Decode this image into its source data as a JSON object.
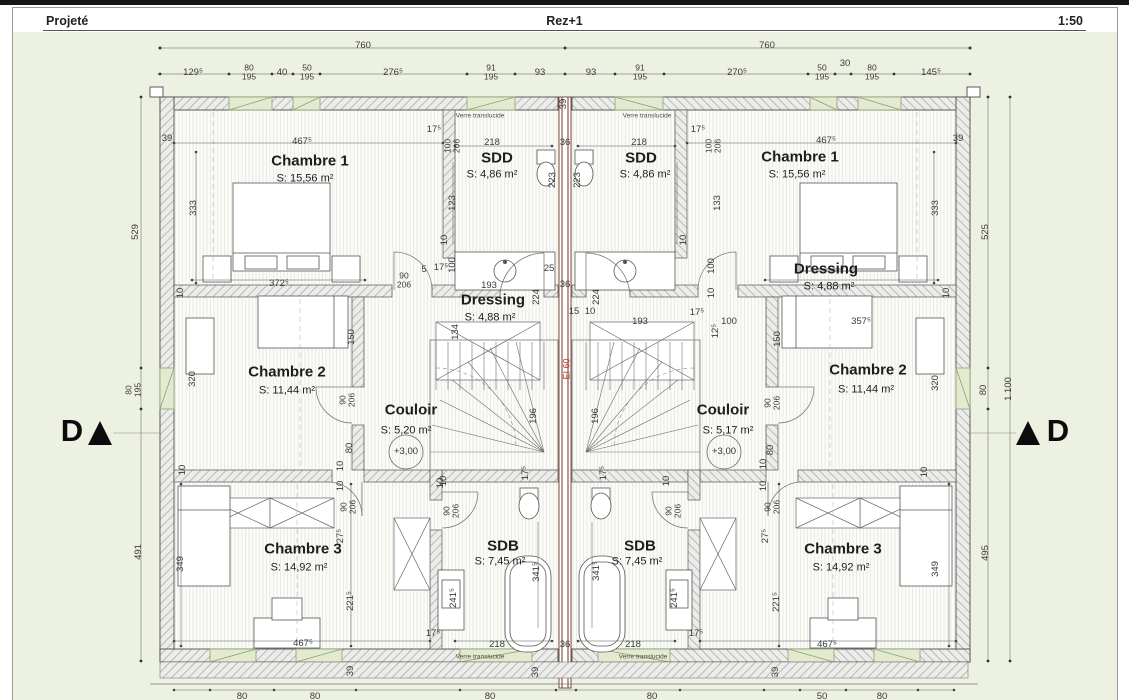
{
  "header": {
    "project_state": "Projeté",
    "level": "Rez+1",
    "scale": "1:50"
  },
  "plan": {
    "fire_rating": {
      "t": "EI 60",
      "x": 567,
      "y": 369
    },
    "markers": {
      "left": "D",
      "right": "D"
    },
    "levels": [
      {
        "t": "+3,00",
        "x": 406,
        "y": 452
      },
      {
        "t": "+3,00",
        "x": 724,
        "y": 452
      }
    ],
    "glass_notes": [
      {
        "t": "Verre translucide",
        "x": 480,
        "y": 117
      },
      {
        "t": "Verre translucide",
        "x": 647,
        "y": 117
      },
      {
        "t": "Verre translucide",
        "x": 480,
        "y": 658
      },
      {
        "t": "Verre translucide",
        "x": 643,
        "y": 658
      }
    ],
    "rooms": [
      {
        "name": "Chambre 1",
        "area": "S: 15,56 m²",
        "nx": 310,
        "ny": 161,
        "ax": 305,
        "ay": 179
      },
      {
        "name": "SDD",
        "area": "S: 4,86 m²",
        "nx": 497,
        "ny": 158,
        "ax": 492,
        "ay": 175
      },
      {
        "name": "Dressing",
        "area": "S: 4,88 m²",
        "nx": 493,
        "ny": 300,
        "ax": 490,
        "ay": 318
      },
      {
        "name": "Chambre 2",
        "area": "S: 11,44 m²",
        "nx": 287,
        "ny": 372,
        "ax": 287,
        "ay": 391
      },
      {
        "name": "Couloir",
        "area": "S: 5,20 m²",
        "nx": 411,
        "ny": 410,
        "ax": 406,
        "ay": 431
      },
      {
        "name": "Chambre 3",
        "area": "S: 14,92 m²",
        "nx": 303,
        "ny": 549,
        "ax": 299,
        "ay": 568
      },
      {
        "name": "SDB",
        "area": "S: 7,45 m²",
        "nx": 503,
        "ny": 546,
        "ax": 500,
        "ay": 562
      },
      {
        "name": "SDD",
        "area": "S: 4,86 m²",
        "nx": 641,
        "ny": 158,
        "ax": 645,
        "ay": 175
      },
      {
        "name": "Chambre 1",
        "area": "S: 15,56 m²",
        "nx": 800,
        "ny": 157,
        "ax": 797,
        "ay": 175
      },
      {
        "name": "Dressing",
        "area": "S: 4,88 m²",
        "nx": 826,
        "ny": 269,
        "ax": 829,
        "ay": 287
      },
      {
        "name": "Chambre 2",
        "area": "S: 11,44 m²",
        "nx": 868,
        "ny": 370,
        "ax": 866,
        "ay": 390
      },
      {
        "name": "Couloir",
        "area": "S: 5,17 m²",
        "nx": 723,
        "ny": 410,
        "ax": 728,
        "ay": 431
      },
      {
        "name": "SDB",
        "area": "S: 7,45 m²",
        "nx": 640,
        "ny": 546,
        "ax": 637,
        "ay": 562
      },
      {
        "name": "Chambre 3",
        "area": "S: 14,92 m²",
        "nx": 843,
        "ny": 549,
        "ax": 841,
        "ay": 568
      }
    ],
    "dims": [
      {
        "t": "760",
        "x": 363,
        "y": 46
      },
      {
        "t": "760",
        "x": 767,
        "y": 46
      },
      {
        "t": "129⁵",
        "x": 193,
        "y": 73
      },
      {
        "t": "80\n195",
        "x": 249,
        "y": 72,
        "s": 1
      },
      {
        "t": "40",
        "x": 282,
        "y": 73
      },
      {
        "t": "50\n195",
        "x": 307,
        "y": 72,
        "s": 1
      },
      {
        "t": "276⁵",
        "x": 393,
        "y": 73
      },
      {
        "t": "91\n195",
        "x": 491,
        "y": 72,
        "s": 1
      },
      {
        "t": "93",
        "x": 540,
        "y": 73
      },
      {
        "t": "93",
        "x": 591,
        "y": 73
      },
      {
        "t": "91\n195",
        "x": 640,
        "y": 72,
        "s": 1
      },
      {
        "t": "270⁵",
        "x": 737,
        "y": 73
      },
      {
        "t": "50\n195",
        "x": 822,
        "y": 72,
        "s": 1
      },
      {
        "t": "30",
        "x": 845,
        "y": 64
      },
      {
        "t": "80\n195",
        "x": 872,
        "y": 72,
        "s": 1
      },
      {
        "t": "145⁵",
        "x": 931,
        "y": 73
      },
      {
        "t": "529",
        "x": 136,
        "y": 232,
        "r": 1
      },
      {
        "t": "80\n195",
        "x": 133,
        "y": 390,
        "r": 1,
        "s": 1
      },
      {
        "t": "491",
        "x": 139,
        "y": 552,
        "r": 1
      },
      {
        "t": "525",
        "x": 986,
        "y": 232,
        "r": 1
      },
      {
        "t": "80",
        "x": 984,
        "y": 390,
        "r": 1
      },
      {
        "t": "495",
        "x": 986,
        "y": 553,
        "r": 1
      },
      {
        "t": "1.100",
        "x": 1009,
        "y": 389,
        "r": 1
      },
      {
        "t": "39",
        "x": 167,
        "y": 139
      },
      {
        "t": "467⁵",
        "x": 302,
        "y": 142
      },
      {
        "t": "17⁵",
        "x": 434,
        "y": 130
      },
      {
        "t": "100\n206",
        "x": 452,
        "y": 146,
        "r": 1,
        "s": 1
      },
      {
        "t": "218",
        "x": 492,
        "y": 143
      },
      {
        "t": "223",
        "x": 553,
        "y": 180,
        "r": 1
      },
      {
        "t": "36",
        "x": 565,
        "y": 143
      },
      {
        "t": "39",
        "x": 564,
        "y": 104,
        "r": 1
      },
      {
        "t": "223",
        "x": 578,
        "y": 180,
        "r": 1
      },
      {
        "t": "218",
        "x": 639,
        "y": 143
      },
      {
        "t": "100\n206",
        "x": 713,
        "y": 146,
        "r": 1,
        "s": 1
      },
      {
        "t": "17⁵",
        "x": 698,
        "y": 130
      },
      {
        "t": "467⁵",
        "x": 826,
        "y": 141
      },
      {
        "t": "39",
        "x": 958,
        "y": 139
      },
      {
        "t": "333",
        "x": 194,
        "y": 208,
        "r": 1
      },
      {
        "t": "123",
        "x": 453,
        "y": 203,
        "r": 1
      },
      {
        "t": "133",
        "x": 718,
        "y": 203,
        "r": 1
      },
      {
        "t": "333",
        "x": 936,
        "y": 208,
        "r": 1
      },
      {
        "t": "10",
        "x": 445,
        "y": 240,
        "r": 1
      },
      {
        "t": "10",
        "x": 684,
        "y": 240,
        "r": 1
      },
      {
        "t": "100",
        "x": 453,
        "y": 265,
        "r": 1
      },
      {
        "t": "100",
        "x": 712,
        "y": 266,
        "r": 1
      },
      {
        "t": "10",
        "x": 181,
        "y": 293,
        "r": 1
      },
      {
        "t": "10",
        "x": 947,
        "y": 293,
        "r": 1
      },
      {
        "t": "372⁵",
        "x": 279,
        "y": 284
      },
      {
        "t": "357⁵",
        "x": 861,
        "y": 322
      },
      {
        "t": "90\n206",
        "x": 404,
        "y": 280,
        "s": 1
      },
      {
        "t": "5",
        "x": 424,
        "y": 270
      },
      {
        "t": "17⁵",
        "x": 441,
        "y": 268
      },
      {
        "t": "25",
        "x": 549,
        "y": 269
      },
      {
        "t": "36",
        "x": 565,
        "y": 285
      },
      {
        "t": "193",
        "x": 489,
        "y": 286
      },
      {
        "t": "15",
        "x": 574,
        "y": 312
      },
      {
        "t": "10",
        "x": 590,
        "y": 312
      },
      {
        "t": "224",
        "x": 537,
        "y": 297,
        "r": 1
      },
      {
        "t": "224",
        "x": 597,
        "y": 297,
        "r": 1
      },
      {
        "t": "134",
        "x": 456,
        "y": 332,
        "r": 1
      },
      {
        "t": "193",
        "x": 640,
        "y": 322
      },
      {
        "t": "17⁵",
        "x": 697,
        "y": 313
      },
      {
        "t": "100",
        "x": 729,
        "y": 322
      },
      {
        "t": "12⁵",
        "x": 716,
        "y": 331,
        "r": 1
      },
      {
        "t": "10",
        "x": 712,
        "y": 293,
        "r": 1
      },
      {
        "t": "320",
        "x": 193,
        "y": 379,
        "r": 1
      },
      {
        "t": "150",
        "x": 352,
        "y": 337,
        "r": 1
      },
      {
        "t": "90\n206",
        "x": 347,
        "y": 400,
        "r": 1,
        "s": 1
      },
      {
        "t": "80",
        "x": 350,
        "y": 448,
        "r": 1
      },
      {
        "t": "10",
        "x": 341,
        "y": 466,
        "r": 1
      },
      {
        "t": "10",
        "x": 183,
        "y": 470,
        "r": 1
      },
      {
        "t": "150",
        "x": 778,
        "y": 339,
        "r": 1
      },
      {
        "t": "320",
        "x": 936,
        "y": 383,
        "r": 1
      },
      {
        "t": "90\n206",
        "x": 772,
        "y": 403,
        "r": 1,
        "s": 1
      },
      {
        "t": "80",
        "x": 771,
        "y": 450,
        "r": 1
      },
      {
        "t": "10",
        "x": 764,
        "y": 464,
        "r": 1
      },
      {
        "t": "10",
        "x": 925,
        "y": 472,
        "r": 1
      },
      {
        "t": "196",
        "x": 534,
        "y": 416,
        "r": 1
      },
      {
        "t": "196",
        "x": 596,
        "y": 416,
        "r": 1
      },
      {
        "t": "17⁵",
        "x": 526,
        "y": 473,
        "r": 1
      },
      {
        "t": "17⁵",
        "x": 604,
        "y": 473,
        "r": 1
      },
      {
        "t": "10",
        "x": 444,
        "y": 481,
        "r": 1
      },
      {
        "t": "10",
        "x": 667,
        "y": 481,
        "r": 1
      },
      {
        "t": "90\n206",
        "x": 348,
        "y": 507,
        "r": 1,
        "s": 1
      },
      {
        "t": "10",
        "x": 341,
        "y": 486,
        "r": 1
      },
      {
        "t": "90\n206",
        "x": 451,
        "y": 511,
        "r": 1,
        "s": 1
      },
      {
        "t": "10",
        "x": 441,
        "y": 483,
        "r": 1
      },
      {
        "t": "90\n206",
        "x": 673,
        "y": 511,
        "r": 1,
        "s": 1
      },
      {
        "t": "90\n206",
        "x": 772,
        "y": 507,
        "r": 1,
        "s": 1
      },
      {
        "t": "10",
        "x": 764,
        "y": 486,
        "r": 1
      },
      {
        "t": "349",
        "x": 181,
        "y": 564,
        "r": 1
      },
      {
        "t": "27⁵",
        "x": 341,
        "y": 536,
        "r": 1
      },
      {
        "t": "221⁵",
        "x": 351,
        "y": 601,
        "r": 1
      },
      {
        "t": "467⁵",
        "x": 303,
        "y": 644
      },
      {
        "t": "39",
        "x": 351,
        "y": 671,
        "r": 1
      },
      {
        "t": "341⁵",
        "x": 537,
        "y": 572,
        "r": 1
      },
      {
        "t": "241⁵",
        "x": 454,
        "y": 598,
        "r": 1
      },
      {
        "t": "17⁵",
        "x": 433,
        "y": 634
      },
      {
        "t": "218",
        "x": 497,
        "y": 645
      },
      {
        "t": "36",
        "x": 565,
        "y": 645
      },
      {
        "t": "39",
        "x": 536,
        "y": 672,
        "r": 1
      },
      {
        "t": "341⁵",
        "x": 597,
        "y": 571,
        "r": 1
      },
      {
        "t": "241⁵",
        "x": 675,
        "y": 598,
        "r": 1
      },
      {
        "t": "218",
        "x": 633,
        "y": 645
      },
      {
        "t": "17⁵",
        "x": 696,
        "y": 634
      },
      {
        "t": "27⁵",
        "x": 766,
        "y": 536,
        "r": 1
      },
      {
        "t": "221⁵",
        "x": 777,
        "y": 602,
        "r": 1
      },
      {
        "t": "349",
        "x": 936,
        "y": 569,
        "r": 1
      },
      {
        "t": "467⁵",
        "x": 827,
        "y": 645
      },
      {
        "t": "39",
        "x": 776,
        "y": 672,
        "r": 1
      },
      {
        "t": "80",
        "x": 242,
        "y": 697
      },
      {
        "t": "80",
        "x": 315,
        "y": 697
      },
      {
        "t": "80",
        "x": 490,
        "y": 697
      },
      {
        "t": "80",
        "x": 652,
        "y": 697
      },
      {
        "t": "50",
        "x": 822,
        "y": 697
      },
      {
        "t": "80",
        "x": 882,
        "y": 697
      }
    ]
  }
}
